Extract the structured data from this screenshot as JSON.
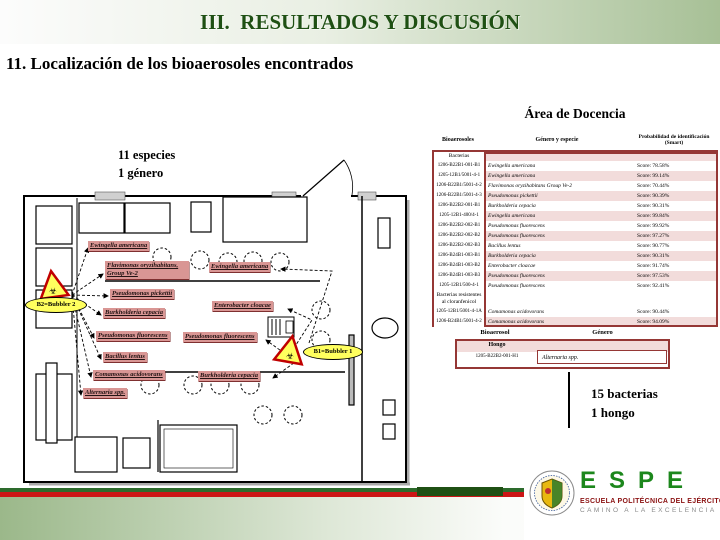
{
  "slide": {
    "header_title": "III.  RESULTADOS Y DISCUSIÓN",
    "section_title": "11. Localización de los bioaerosoles encontrados"
  },
  "left_summary": {
    "line1": "11 especies",
    "line2": "1 género"
  },
  "right_summary": {
    "line1": "15 bacterias",
    "line2": "1 hongo"
  },
  "docencia": {
    "title": "Área de Docencia",
    "col_bioaerosoles": "Bioaerosoles",
    "col_genero": "Género y especie",
    "col_prob": "Probabilidad de identificación (Smart)",
    "category_bacterias": "Bacterias",
    "category_resistentes": "Bacterias resistentes al cloranfenicol",
    "rows": [
      {
        "code": "1206-B22B1-001-B1",
        "species": "Ewingella americana",
        "score": "Score: 78.58%"
      },
      {
        "code": "1205-12B1/5001-4-1",
        "species": "Ewingella americana",
        "score": "Score: 99.14%"
      },
      {
        "code": "1206-B22B1/5001-4-2",
        "species": "Flavimonas oryzihabitans Group Ve-2",
        "score": "Score: 70.44%"
      },
      {
        "code": "1206-B22B1/5001-4-3",
        "species": "Pseudomonas pickettii",
        "score": "Score: 90.39%"
      },
      {
        "code": "1206-B22B2-001-B1",
        "species": "Burkholderia cepacia",
        "score": "Score: 90.31%"
      },
      {
        "code": "1205-12B1-400/4-1",
        "species": "Ewingella americana",
        "score": "Score: 99.84%"
      },
      {
        "code": "1206-B22B2-002-B1",
        "species": "Pseudomonas fluorescens",
        "score": "Score: 99.92%"
      },
      {
        "code": "1206-B22B2-002-B2",
        "species": "Pseudomonas fluorescens",
        "score": "Score: 97.27%"
      },
      {
        "code": "1206-B22B2-002-B3",
        "species": "Bacillus lentus",
        "score": "Score: 90.77%"
      },
      {
        "code": "1206-B24B1-003-B1",
        "species": "Burkholderia cepacia",
        "score": "Score: 90.31%"
      },
      {
        "code": "1206-B24B1-003-B2",
        "species": "Enterobacter cloacae",
        "score": "Score: 91.74%"
      },
      {
        "code": "1206-B24B1-003-B3",
        "species": "Pseudomonas fluorescens",
        "score": "Score: 97.53%"
      },
      {
        "code": "1205-12B1/500-4-1",
        "species": "Pseudomonas fluorescens",
        "score": "Score: 92.41%"
      }
    ],
    "resistant_rows": [
      {
        "code": "1205-12B1/5001-4-1A",
        "species": "Comamonas acidovorans",
        "score": "Score: 90.44%"
      },
      {
        "code": "1206-B24B1/5001-4-2",
        "species": "Comamonas acidovorans",
        "score": "Score: 94.09%"
      }
    ]
  },
  "hongo": {
    "col_bioaerosol": "Bioaerosol",
    "col_genero": "Género",
    "category": "Hongo",
    "code": "1205-B22B2-001-H1",
    "species": "Alternaria spp."
  },
  "floorplan": {
    "labels": [
      "Ewingella americana",
      "Flavimonas oryzihabitans, Group Ve-2",
      "Ewingella americana",
      "Pseudomonas pickettii",
      "Burkholderia cepacia",
      "Enterobacter cloacae",
      "Pseudomonas fluorescens",
      "Pseudomonas fluorescens",
      "Bacillus lentus",
      "Comamonas acidovorans",
      "Burkholderia cepacia",
      "Alternaria spp."
    ],
    "bubbler2": "B2=Bubbler 2",
    "bubbler1": "B1=Bubbler 1",
    "hazard_symbol": "☣"
  },
  "footer": {
    "espe": "ESPE",
    "school": "ESCUELA POLITÉCNICA DEL EJÉRCITO",
    "motto": "CAMINO A LA EXCELENCIA"
  },
  "colors": {
    "accent_green": "#1f5014",
    "table_border_red": "#953735",
    "row_pink": "#f2dcdb",
    "label_pink": "#d99694",
    "bubbler_yellow": "#ffff5e",
    "stripe_red": "#cc1515",
    "stripe_green": "#2d6b2d",
    "espe_green": "#1c871c"
  }
}
